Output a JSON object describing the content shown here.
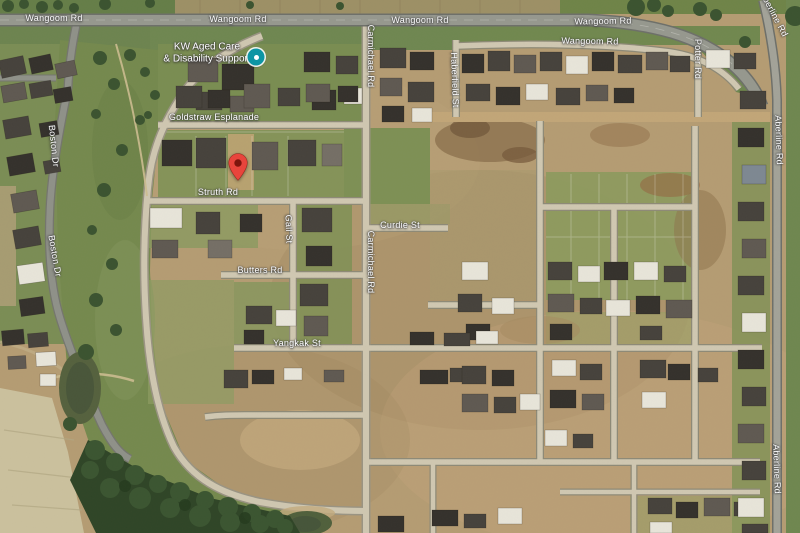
{
  "map": {
    "view_type": "satellite",
    "road_labels": [
      {
        "text": "Wangoom Rd",
        "x": 54,
        "y": 18,
        "rot": 0
      },
      {
        "text": "Wangoom Rd",
        "x": 238,
        "y": 19,
        "rot": 0
      },
      {
        "text": "Wangoom Rd",
        "x": 420,
        "y": 20,
        "rot": 0
      },
      {
        "text": "Wangoom Rd",
        "x": 603,
        "y": 21,
        "rot": -1
      },
      {
        "text": "Wangoom Rd",
        "x": 590,
        "y": 41,
        "rot": 1
      },
      {
        "text": "Goldstraw Esplanade",
        "x": 214,
        "y": 117,
        "rot": 0
      },
      {
        "text": "Struth Rd",
        "x": 218,
        "y": 192,
        "rot": 0
      },
      {
        "text": "Curdie St",
        "x": 400,
        "y": 225,
        "rot": 0
      },
      {
        "text": "Butters Rd",
        "x": 260,
        "y": 270,
        "rot": 0
      },
      {
        "text": "Yangkak St",
        "x": 297,
        "y": 343,
        "rot": 0
      },
      {
        "text": "Boston Dr",
        "x": 54,
        "y": 146,
        "rot": 84
      },
      {
        "text": "Boston Dr",
        "x": 55,
        "y": 256,
        "rot": 80
      },
      {
        "text": "Carmichael Rd",
        "x": 371,
        "y": 56,
        "rot": 90
      },
      {
        "text": "Carmichael Rd",
        "x": 371,
        "y": 262,
        "rot": 90
      },
      {
        "text": "Haberfield St",
        "x": 455,
        "y": 80,
        "rot": 88
      },
      {
        "text": "Gall St",
        "x": 289,
        "y": 229,
        "rot": 88
      },
      {
        "text": "Potter Rd",
        "x": 698,
        "y": 59,
        "rot": 90
      },
      {
        "text": "Aberline Rd",
        "x": 774,
        "y": 14,
        "rot": 62
      },
      {
        "text": "Aberline Rd",
        "x": 779,
        "y": 140,
        "rot": 88
      },
      {
        "text": "Aberline Rd",
        "x": 777,
        "y": 469,
        "rot": 88
      }
    ],
    "poi": {
      "lines": [
        "KW Aged Care",
        "& Disability Support"
      ],
      "x": 207,
      "y": 53,
      "icon": "place-dot-icon",
      "icon_x": 256,
      "icon_y": 57,
      "icon_color": "#0e95a4"
    },
    "marker": {
      "icon": "red-map-pin-icon",
      "x": 238,
      "y": 181,
      "color": "#e8453c",
      "dot_color": "#7e150d"
    },
    "colors": {
      "grass_green": "#75894f",
      "dirt_tan": "#b59c73",
      "tree_green": "#3b5330",
      "water_green": "#50603c",
      "road_asphalt": "#96988f",
      "road_concrete": "#d0c8b2",
      "label_white": "#ffffff",
      "farmland": "#cbc19e"
    }
  }
}
